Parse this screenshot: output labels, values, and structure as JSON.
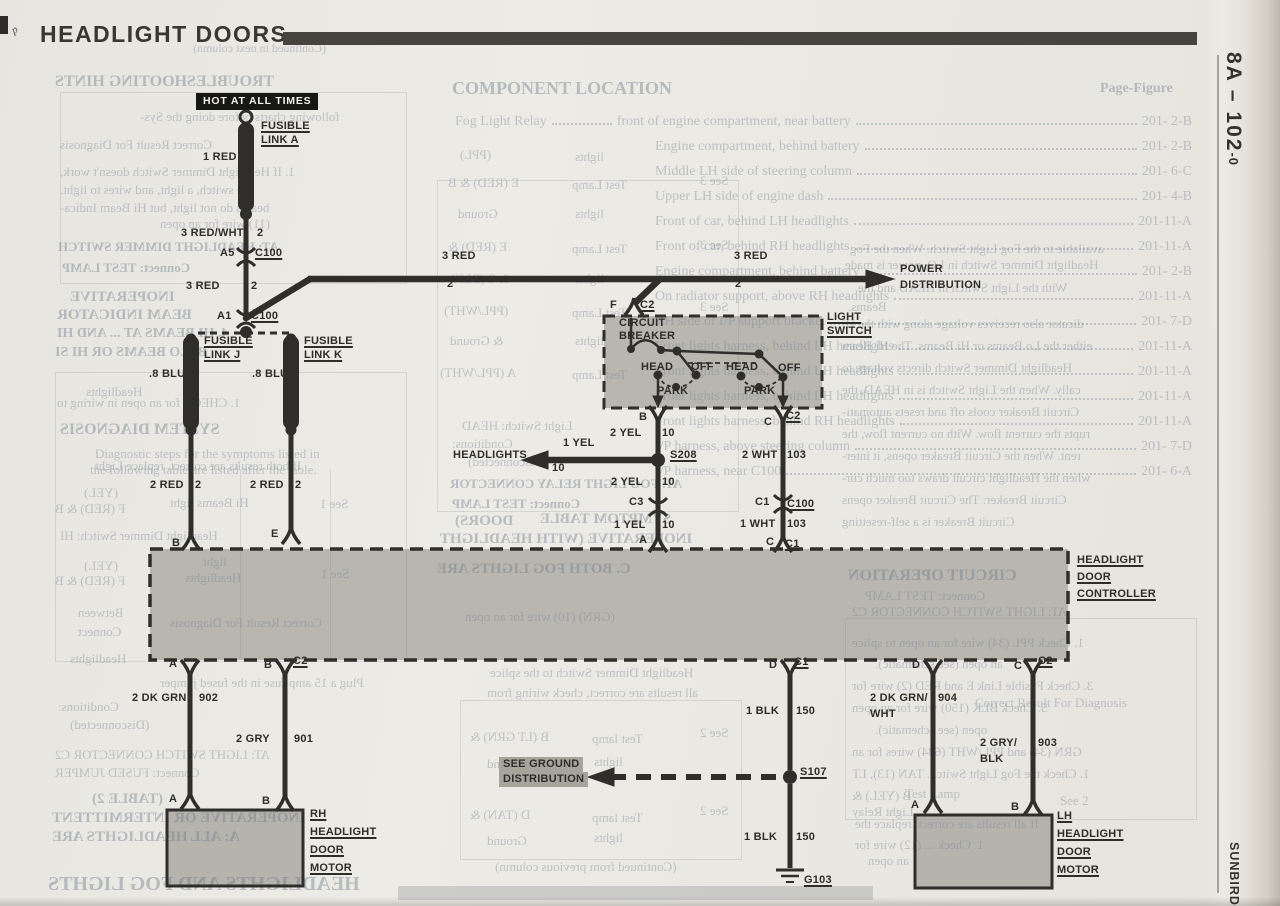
{
  "page": {
    "title": "HEADLIGHT DOORS",
    "page_ref": "8A – 102",
    "page_ref_suffix": "-0",
    "brand": "SUNBIRD",
    "corner_mark": "p"
  },
  "d": {
    "two": "2",
    "ten": "10",
    "n103": "103",
    "hot": "HOT AT ALL TIMES",
    "fusible": "FUSIBLE",
    "linkA": "LINK A",
    "linkJ": "LINK J",
    "linkK": "LINK K",
    "red1": "1 RED",
    "redwht3": "3 RED/WHT",
    "red3": "3 RED",
    "red2": "2 RED",
    "blu8": ".8 BLU",
    "a5": "A5",
    "a1": "A1",
    "c100": "C100",
    "c1": "C1",
    "c2": "C2",
    "c3": "C3",
    "A": "A",
    "B": "B",
    "C": "C",
    "D": "D",
    "E": "E",
    "F": "F",
    "power": "POWER",
    "distribution": "DISTRIBUTION",
    "circuit": "CIRCUIT",
    "breaker": "BREAKER",
    "head": "HEAD",
    "off": "OFF",
    "park": "PARK",
    "light": "LIGHT",
    "sw": "SWITCH",
    "yel2": "2 YEL",
    "yel1": "1 YEL",
    "headlights": "HEADLIGHTS",
    "s208": "S208",
    "wht2": "2 WHT",
    "wht1": "1 WHT",
    "headlight": "HEADLIGHT",
    "door": "DOOR",
    "controller": "CONTROLLER",
    "dkgrn2": "2 DK GRN",
    "n902": "902",
    "gry2": "2 GRY",
    "n901": "901",
    "rh": "RH",
    "lh": "LH",
    "motor": "MOTOR",
    "blk1": "1 BLK",
    "n150": "150",
    "s107": "S107",
    "g103": "G103",
    "seeground": "SEE GROUND",
    "dkgrnwht2": "2 DK GRN/",
    "wht": "WHT",
    "n904": "904",
    "grys2": "2 GRY/",
    "blk": "BLK",
    "n903": "903"
  },
  "component_location": {
    "title": "COMPONENT LOCATION",
    "page_figure": "Page-Figure",
    "lead": "Fog Light Relay",
    "rows": [
      {
        "loc": "front of engine compartment, near battery",
        "ref": "201- 2-B"
      },
      {
        "loc": "Engine compartment, behind battery",
        "ref": "201- 2-B"
      },
      {
        "loc": "Middle LH side of steering column",
        "ref": "201- 6-C"
      },
      {
        "loc": "Upper LH side of engine dash",
        "ref": "201- 4-B"
      },
      {
        "loc": "Front of car, behind LH headlights",
        "ref": "201-11-A"
      },
      {
        "loc": "Front of car, behind RH headlights",
        "ref": "201-11-A"
      },
      {
        "loc": "Engine compartment, behind battery",
        "ref": "201- 2-B"
      },
      {
        "loc": "On radiator support, above RH headlights",
        "ref": "201-11-A"
      },
      {
        "loc": "RH side of I/P support bracket",
        "ref": "201- 7-D"
      },
      {
        "loc": "Front lights harness, behind LH headlights",
        "ref": "201-11-A"
      },
      {
        "loc": "Front lights harness, behind LH headlights",
        "ref": "201-11-A"
      },
      {
        "loc": "Front lights harness, behind LH headlights",
        "ref": "201-11-A"
      },
      {
        "loc": "Front lights harness, behind RH headlights",
        "ref": "201-11-A"
      },
      {
        "loc": "I/P harness, above steering column",
        "ref": "201- 7-D"
      },
      {
        "loc": "I/P harness, near C100",
        "ref": "201- 6-A"
      }
    ]
  },
  "ghosts": [
    {
      "t": "(Continued in next column)",
      "x": 193,
      "y": 42,
      "s": 12,
      "m": 1,
      "b": 0
    },
    {
      "t": "TROUBLESHOOTING HINTS",
      "x": 55,
      "y": 74,
      "s": 16,
      "m": 1,
      "b": 1
    },
    {
      "t": "following charts before doing the Sys-",
      "x": 140,
      "y": 110,
      "s": 13,
      "m": 1,
      "b": 0
    },
    {
      "t": "Correct Result      For Diagnosis",
      "x": 60,
      "y": 138,
      "s": 13,
      "m": 1,
      "b": 0
    },
    {
      "t": "1. If Headlight Dimmer Switch doesn't work,",
      "x": 60,
      "y": 165,
      "s": 13,
      "m": 1,
      "b": 0
    },
    {
      "t": "the switch, a light, and wires to light.",
      "x": 60,
      "y": 183,
      "s": 13,
      "m": 1,
      "b": 0
    },
    {
      "t": "beams do not light, but Hi Beam Indica-",
      "x": 60,
      "y": 201,
      "s": 13,
      "m": 1,
      "b": 0
    },
    {
      "t": "(11) wire for an open",
      "x": 160,
      "y": 217,
      "s": 13,
      "m": 1,
      "b": 0
    },
    {
      "t": "AT: HEADLIGHT DIMMER SWITCH",
      "x": 58,
      "y": 240,
      "s": 13,
      "m": 1,
      "b": 1
    },
    {
      "t": "Connect: TEST LAMP",
      "x": 62,
      "y": 261,
      "s": 13,
      "m": 1,
      "b": 1
    },
    {
      "t": "INOPERATIVE",
      "x": 70,
      "y": 290,
      "s": 15,
      "m": 1,
      "b": 1
    },
    {
      "t": "BEAM INDICATOR",
      "x": 57,
      "y": 308,
      "s": 15,
      "m": 1,
      "b": 1
    },
    {
      "t": "4. HI BEAMS AT ... AND HI",
      "x": 57,
      "y": 327,
      "s": 14,
      "m": 1,
      "b": 1
    },
    {
      "t": "B: LO BEAMS OR HI SI",
      "x": 55,
      "y": 346,
      "s": 14,
      "m": 1,
      "b": 1
    },
    {
      "t": "Headlights",
      "x": 86,
      "y": 385,
      "s": 13,
      "m": 1,
      "b": 0
    },
    {
      "t": "1. CHECK for an open in wiring to",
      "x": 57,
      "y": 396,
      "s": 13,
      "m": 1,
      "b": 0
    },
    {
      "t": "SYSTEM DIAGNOSIS",
      "x": 60,
      "y": 422,
      "s": 16,
      "m": 1,
      "b": 1
    },
    {
      "t": "Diagnostic steps for the symptoms listed in",
      "x": 95,
      "y": 447,
      "s": 13,
      "m": 0,
      "b": 0
    },
    {
      "t": "the following table are listed after the table.",
      "x": 90,
      "y": 463,
      "s": 13,
      "m": 0,
      "b": 0
    },
    {
      "t": "If both results are correct, replace Light",
      "x": 95,
      "y": 459,
      "s": 13,
      "m": 1,
      "b": 0
    },
    {
      "t": "(YEL)",
      "x": 84,
      "y": 486,
      "s": 13,
      "m": 1,
      "b": 0
    },
    {
      "t": "F (RED) & B",
      "x": 55,
      "y": 502,
      "s": 13,
      "m": 1,
      "b": 0
    },
    {
      "t": "Hi Beams light",
      "x": 170,
      "y": 496,
      "s": 13,
      "m": 1,
      "b": 0
    },
    {
      "t": "See 1",
      "x": 320,
      "y": 497,
      "s": 13,
      "m": 1,
      "b": 0
    },
    {
      "t": "Headlight Dimmer Switch: HI",
      "x": 60,
      "y": 529,
      "s": 13,
      "m": 1,
      "b": 0
    },
    {
      "t": "(YEL)",
      "x": 84,
      "y": 559,
      "s": 13,
      "m": 1,
      "b": 0
    },
    {
      "t": "F (RED) & B",
      "x": 55,
      "y": 574,
      "s": 13,
      "m": 1,
      "b": 0
    },
    {
      "t": "light",
      "x": 203,
      "y": 555,
      "s": 13,
      "m": 1,
      "b": 0
    },
    {
      "t": "Headlights",
      "x": 185,
      "y": 571,
      "s": 13,
      "m": 1,
      "b": 0
    },
    {
      "t": "See 1",
      "x": 321,
      "y": 567,
      "s": 13,
      "m": 1,
      "b": 0
    },
    {
      "t": "Between",
      "x": 78,
      "y": 606,
      "s": 13,
      "m": 1,
      "b": 0
    },
    {
      "t": "Connect",
      "x": 78,
      "y": 625,
      "s": 13,
      "m": 1,
      "b": 0
    },
    {
      "t": "Correct Result      For Diagnosis",
      "x": 170,
      "y": 616,
      "s": 13,
      "m": 1,
      "b": 0
    },
    {
      "t": "Headlights",
      "x": 70,
      "y": 652,
      "s": 13,
      "m": 1,
      "b": 0
    },
    {
      "t": "Plug a 15 amp fuse in the fused jumper",
      "x": 160,
      "y": 676,
      "s": 13,
      "m": 1,
      "b": 0
    },
    {
      "t": "Conditions:",
      "x": 58,
      "y": 700,
      "s": 13,
      "m": 1,
      "b": 0
    },
    {
      "t": "(Disconnected)",
      "x": 70,
      "y": 718,
      "s": 13,
      "m": 1,
      "b": 0
    },
    {
      "t": "AT: LIGHT SWITCH CONNECTOR C2",
      "x": 55,
      "y": 748,
      "s": 13,
      "m": 1,
      "b": 0
    },
    {
      "t": "Connect: FUSED JUMPER",
      "x": 55,
      "y": 766,
      "s": 13,
      "m": 1,
      "b": 0
    },
    {
      "t": "(TABLE 2)",
      "x": 92,
      "y": 792,
      "s": 15,
      "m": 1,
      "b": 1
    },
    {
      "t": "INOPERATIVE OR INTERMITTENT",
      "x": 52,
      "y": 811,
      "s": 15,
      "m": 1,
      "b": 1
    },
    {
      "t": "A: ALL HEADLIGHTS ARE",
      "x": 52,
      "y": 830,
      "s": 15,
      "m": 1,
      "b": 1
    },
    {
      "t": "HEADLIGHTS AND FOG LIGHTS",
      "x": 48,
      "y": 874,
      "s": 20,
      "m": 1,
      "b": 1
    },
    {
      "t": "(PPL)",
      "x": 460,
      "y": 148,
      "s": 13,
      "m": 1,
      "b": 0
    },
    {
      "t": "lights",
      "x": 575,
      "y": 150,
      "s": 13,
      "m": 1,
      "b": 0
    },
    {
      "t": "E (RED) & B",
      "x": 448,
      "y": 176,
      "s": 13,
      "m": 1,
      "b": 0
    },
    {
      "t": "Test Lamp",
      "x": 572,
      "y": 178,
      "s": 13,
      "m": 1,
      "b": 0
    },
    {
      "t": "See 3",
      "x": 700,
      "y": 174,
      "s": 13,
      "m": 1,
      "b": 0
    },
    {
      "t": "Ground",
      "x": 458,
      "y": 207,
      "s": 13,
      "m": 1,
      "b": 0
    },
    {
      "t": "lights",
      "x": 575,
      "y": 207,
      "s": 13,
      "m": 1,
      "b": 0
    },
    {
      "t": "E (RED) &",
      "x": 448,
      "y": 240,
      "s": 13,
      "m": 1,
      "b": 0
    },
    {
      "t": "Test Lamp",
      "x": 572,
      "y": 242,
      "s": 13,
      "m": 1,
      "b": 0
    },
    {
      "t": "See 3",
      "x": 700,
      "y": 238,
      "s": 13,
      "m": 1,
      "b": 0
    },
    {
      "t": "& C (BLK)",
      "x": 450,
      "y": 272,
      "s": 13,
      "m": 1,
      "b": 0
    },
    {
      "t": "lights",
      "x": 575,
      "y": 272,
      "s": 13,
      "m": 1,
      "b": 0
    },
    {
      "t": "(PPL/WHT)",
      "x": 444,
      "y": 304,
      "s": 13,
      "m": 1,
      "b": 0
    },
    {
      "t": "Test Lamp",
      "x": 572,
      "y": 306,
      "s": 13,
      "m": 1,
      "b": 0
    },
    {
      "t": "See 3",
      "x": 700,
      "y": 300,
      "s": 13,
      "m": 1,
      "b": 0
    },
    {
      "t": "& Ground",
      "x": 450,
      "y": 334,
      "s": 13,
      "m": 1,
      "b": 0
    },
    {
      "t": "lights",
      "x": 575,
      "y": 334,
      "s": 13,
      "m": 1,
      "b": 0
    },
    {
      "t": "A (PPL/WHT)",
      "x": 440,
      "y": 366,
      "s": 13,
      "m": 1,
      "b": 0
    },
    {
      "t": "Test Lamp",
      "x": 572,
      "y": 368,
      "s": 13,
      "m": 1,
      "b": 0
    },
    {
      "t": "Light Switch: HEAD",
      "x": 462,
      "y": 419,
      "s": 13,
      "m": 1,
      "b": 0
    },
    {
      "t": "Conditions:",
      "x": 452,
      "y": 437,
      "s": 13,
      "m": 1,
      "b": 0
    },
    {
      "t": "(Disconnected)",
      "x": 468,
      "y": 455,
      "s": 13,
      "m": 1,
      "b": 0
    },
    {
      "t": "AT: FOG LIGHT RELAY CONNECTOR",
      "x": 450,
      "y": 477,
      "s": 13,
      "m": 1,
      "b": 1
    },
    {
      "t": "Connect: TEST LAMP",
      "x": 452,
      "y": 497,
      "s": 13,
      "m": 1,
      "b": 1
    },
    {
      "t": "DOORS)",
      "x": 455,
      "y": 514,
      "s": 15,
      "m": 1,
      "b": 1
    },
    {
      "t": "SYMPTOM TABLE",
      "x": 540,
      "y": 512,
      "s": 15,
      "m": 1,
      "b": 1
    },
    {
      "t": "INOPERATIVE (WITH HEADLIGHT",
      "x": 440,
      "y": 532,
      "s": 15,
      "m": 1,
      "b": 1
    },
    {
      "t": "C. BOTH FOG LIGHTS ARE",
      "x": 437,
      "y": 562,
      "s": 15,
      "m": 1,
      "b": 1
    },
    {
      "t": "(GRN) (10) wire for an open",
      "x": 465,
      "y": 610,
      "s": 13,
      "m": 1,
      "b": 0
    },
    {
      "t": "Headlight Dimmer Switch to the splice",
      "x": 490,
      "y": 666,
      "s": 13,
      "m": 1,
      "b": 0
    },
    {
      "t": "all results are correct, check wiring from",
      "x": 487,
      "y": 686,
      "s": 13,
      "m": 1,
      "b": 0
    },
    {
      "t": "B (LT GRN) &",
      "x": 470,
      "y": 730,
      "s": 13,
      "m": 1,
      "b": 0
    },
    {
      "t": "Test lamp",
      "x": 592,
      "y": 732,
      "s": 13,
      "m": 1,
      "b": 0
    },
    {
      "t": "See 2",
      "x": 700,
      "y": 726,
      "s": 13,
      "m": 1,
      "b": 0
    },
    {
      "t": "Ground",
      "x": 487,
      "y": 757,
      "s": 13,
      "m": 1,
      "b": 0
    },
    {
      "t": "lights",
      "x": 594,
      "y": 755,
      "s": 13,
      "m": 1,
      "b": 0
    },
    {
      "t": "D (TAN) &",
      "x": 470,
      "y": 808,
      "s": 13,
      "m": 1,
      "b": 0
    },
    {
      "t": "Test lamp",
      "x": 592,
      "y": 811,
      "s": 13,
      "m": 1,
      "b": 0
    },
    {
      "t": "See 2",
      "x": 700,
      "y": 804,
      "s": 13,
      "m": 1,
      "b": 0
    },
    {
      "t": "Ground",
      "x": 487,
      "y": 834,
      "s": 13,
      "m": 1,
      "b": 0
    },
    {
      "t": "lights",
      "x": 594,
      "y": 831,
      "s": 13,
      "m": 1,
      "b": 0
    },
    {
      "t": "(Continued from previous column)",
      "x": 495,
      "y": 860,
      "s": 13,
      "m": 1,
      "b": 0
    },
    {
      "t": "available to the Fog Light Switch. When the Fog",
      "x": 850,
      "y": 242,
      "s": 13,
      "m": 1,
      "b": 0
    },
    {
      "t": "Headlight Dimmer Switch in LO, power is made",
      "x": 845,
      "y": 258,
      "s": 13,
      "m": 1,
      "b": 0
    },
    {
      "t": "With the Light Switch in HEAD and the",
      "x": 858,
      "y": 281,
      "s": 13,
      "m": 1,
      "b": 0
    },
    {
      "t": "Beams.",
      "x": 848,
      "y": 300,
      "s": 13,
      "m": 1,
      "b": 0
    },
    {
      "t": "dicator also receives voltage along with the Hi",
      "x": 842,
      "y": 317,
      "s": 13,
      "m": 1,
      "b": 0
    },
    {
      "t": "either the Lo Beams or Hi Beams. The Hi Beam",
      "x": 842,
      "y": 339,
      "s": 13,
      "m": 1,
      "b": 0
    },
    {
      "t": "Headlight Dimmer Switch directs voltage to",
      "x": 842,
      "y": 361,
      "s": 13,
      "m": 1,
      "b": 0
    },
    {
      "t": "cally. When the Light Switch is in HEAD, the",
      "x": 842,
      "y": 383,
      "s": 13,
      "m": 1,
      "b": 0
    },
    {
      "t": "Circuit Breaker cools off and resets automati-",
      "x": 842,
      "y": 405,
      "s": 13,
      "m": 1,
      "b": 0
    },
    {
      "t": "rupts the current flow. With no current flow, the",
      "x": 842,
      "y": 427,
      "s": 13,
      "m": 1,
      "b": 0
    },
    {
      "t": "rent. When the Circuit Breaker opens, it inter-",
      "x": 842,
      "y": 449,
      "s": 13,
      "m": 1,
      "b": 0
    },
    {
      "t": "when the Headlight circuit draws too much cur-",
      "x": 842,
      "y": 471,
      "s": 13,
      "m": 1,
      "b": 0
    },
    {
      "t": "Circuit Breaker: The Circuit Breaker opens",
      "x": 842,
      "y": 493,
      "s": 13,
      "m": 1,
      "b": 0
    },
    {
      "t": "Circuit Breaker is a self-resetting",
      "x": 842,
      "y": 515,
      "s": 13,
      "m": 1,
      "b": 0
    },
    {
      "t": "CIRCUIT OPERATION",
      "x": 848,
      "y": 568,
      "s": 16,
      "m": 1,
      "b": 1
    },
    {
      "t": "Connect: TEST LAMP",
      "x": 865,
      "y": 589,
      "s": 13,
      "m": 1,
      "b": 0
    },
    {
      "t": "AT: LIGHT SWITCH CONNECTOR C2",
      "x": 852,
      "y": 605,
      "s": 13,
      "m": 1,
      "b": 0
    },
    {
      "t": "1. Check PPL (34) wire for an open to splice",
      "x": 852,
      "y": 636,
      "s": 13,
      "m": 1,
      "b": 0
    },
    {
      "t": "an open (see schematic).",
      "x": 875,
      "y": 657,
      "s": 13,
      "m": 1,
      "b": 0
    },
    {
      "t": "3. Check Fusible Link E and RED (2) wire for",
      "x": 852,
      "y": 679,
      "s": 13,
      "m": 1,
      "b": 0
    },
    {
      "t": "Correct Result    For Diagnosis",
      "x": 975,
      "y": 696,
      "s": 13,
      "m": 0,
      "b": 0
    },
    {
      "t": "5. Check BLK (150) wire for an open",
      "x": 852,
      "y": 701,
      "s": 13,
      "m": 1,
      "b": 0
    },
    {
      "t": "open (see schematic).",
      "x": 875,
      "y": 723,
      "s": 13,
      "m": 1,
      "b": 0
    },
    {
      "t": "GRN (34) and PPL/WHT (634) wires for an",
      "x": 852,
      "y": 745,
      "s": 13,
      "m": 1,
      "b": 0
    },
    {
      "t": "1. Check the Fog Light Switch. TAN (13), LT",
      "x": 852,
      "y": 767,
      "s": 13,
      "m": 1,
      "b": 0
    },
    {
      "t": "Test Lamp",
      "x": 905,
      "y": 787,
      "s": 13,
      "m": 0,
      "b": 0
    },
    {
      "t": "See 2",
      "x": 1060,
      "y": 794,
      "s": 13,
      "m": 0,
      "b": 0
    },
    {
      "t": "B (YEL) &",
      "x": 852,
      "y": 789,
      "s": 13,
      "m": 1,
      "b": 0
    },
    {
      "t": "Light Relay",
      "x": 852,
      "y": 805,
      "s": 13,
      "m": 1,
      "b": 0
    },
    {
      "t": "If all results are correct, replace the",
      "x": 855,
      "y": 817,
      "s": 13,
      "m": 1,
      "b": 0
    },
    {
      "t": "1. Check ... (12) wire for",
      "x": 855,
      "y": 838,
      "s": 13,
      "m": 1,
      "b": 0
    },
    {
      "t": "an open",
      "x": 868,
      "y": 854,
      "s": 13,
      "m": 1,
      "b": 0
    }
  ]
}
